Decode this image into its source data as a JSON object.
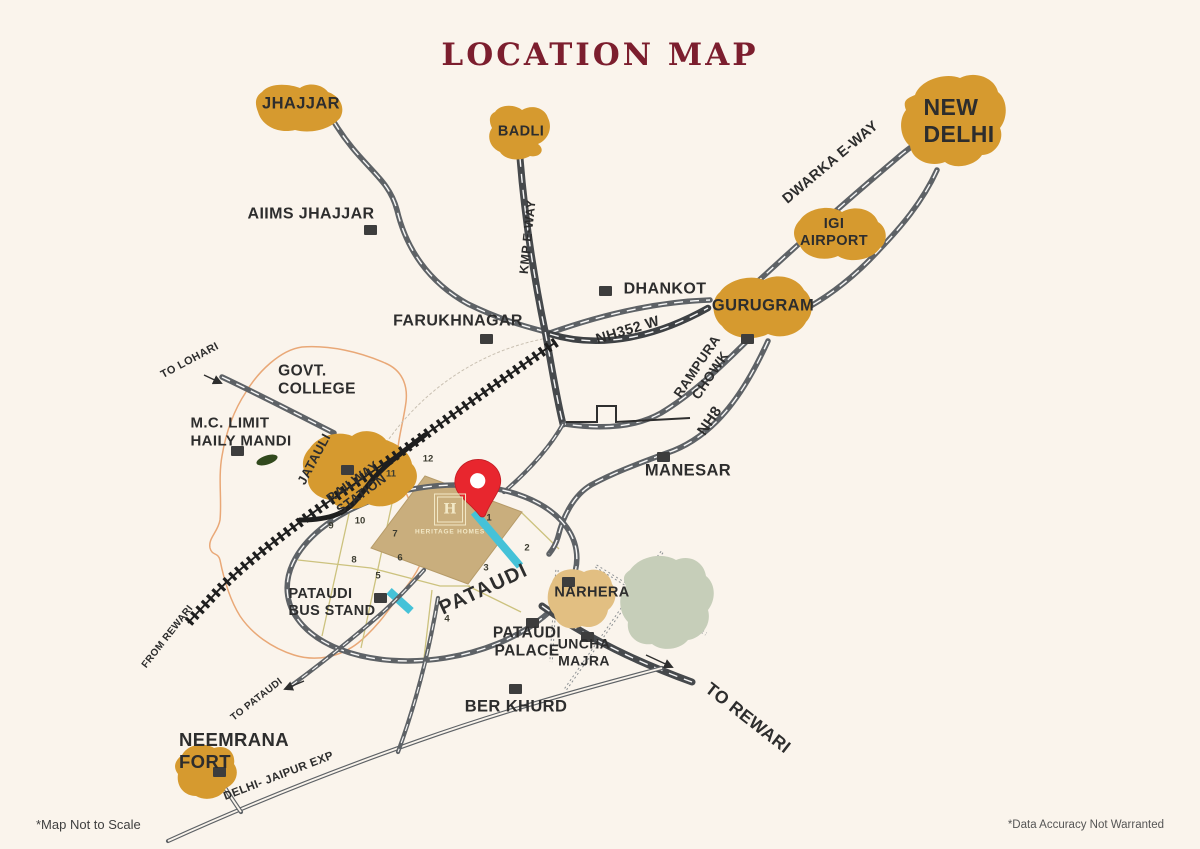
{
  "title": "LOCATION MAP",
  "footnotes": {
    "left": "*Map Not to Scale",
    "right": "*Data Accuracy Not Warranted"
  },
  "places": {
    "jhajjar": "JHAJJAR",
    "badli": "BADLI",
    "new_delhi": "NEW\nDELHI",
    "aiims_jhajjar": "AIIMS JHAJJAR",
    "farukhnagar": "FARUKHNAGAR",
    "dhankot": "DHANKOT",
    "gurugram": "GURUGRAM",
    "igi_airport": "IGI\nAIRPORT",
    "govt_college": "GOVT.\nCOLLEGE",
    "mc_limit_haily_mandi": "M.C. LIMIT\nHAILY MANDI",
    "jatauli": "JATAULI",
    "railway_station": "RAILWAY\nSTATION",
    "manesar": "MANESAR",
    "pataudi": "PATAUDI",
    "narhera": "NARHERA",
    "pataudi_bus_stand": "PATAUDI\nBUS STAND",
    "pataudi_palace": "PATAUDI\nPALACE",
    "uncha_majra": "UNCHA\nMAJRA",
    "ber_khurd": "BER KHURD",
    "neemrana_fort": "NEEMRANA\nFORT"
  },
  "roads": {
    "kmp_eway": "KMP E-WAY",
    "dwarka_eway": "DWARKA E-WAY",
    "nh352w": "NH352 W",
    "rampura_chowk": "RAMPURA\nCHOWK",
    "nh8": "NH8",
    "to_lohari": "TO LOHARI",
    "to_rewari": "TO REWARI",
    "from_rewari": "FROM REWARI",
    "to_pataudi": "TO PATAUDI",
    "delhi_jaipur_exp": "DELHI- JAIPUR EXP"
  },
  "site": {
    "monogram": "H",
    "name": "HERITAGE HOMES",
    "plots": [
      "1",
      "2",
      "3",
      "4",
      "5",
      "6",
      "7",
      "8",
      "9",
      "10",
      "11",
      "12"
    ]
  },
  "colors": {
    "background": "#faf4ec",
    "title_maroon": "#7c1e2e",
    "city_gold": "#d69a2f",
    "narhera_tan": "#e2bf82",
    "greenery": "#c6ceb9",
    "forest_green": "#31491d",
    "site_tan": "#c9ae7d",
    "water_cyan": "#45c2d8",
    "road_grey": "#5e6266",
    "road_dark": "#3e4144",
    "railway_black": "#1e1e1e",
    "label_dark": "#2d2d2d",
    "marker_dark": "#3d3d3d",
    "boundary_orange": "#e9a877",
    "pin_red": "#e8262e",
    "logo_cream": "#f2e8c6",
    "plot_line_olive": "#ccc27e"
  }
}
